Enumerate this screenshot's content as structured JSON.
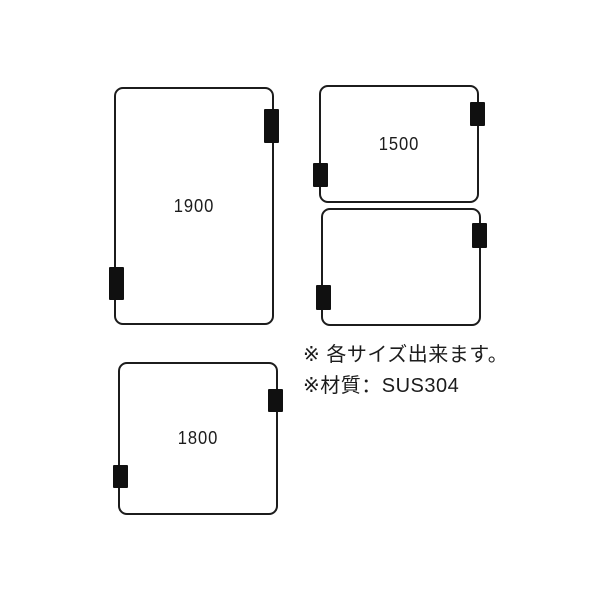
{
  "diagram": {
    "panels": [
      {
        "id": "panel-1900",
        "label": "1900"
      },
      {
        "id": "panel-1500",
        "label": "1500"
      },
      {
        "id": "panel-unlabeled",
        "label": ""
      },
      {
        "id": "panel-1800",
        "label": "1800"
      }
    ],
    "notes": {
      "line1": "※ 各サイズ出来ます。",
      "line2": "※材質：SUS304"
    },
    "icons": {
      "hinge": "filled-black-rectangle"
    },
    "colors": {
      "line": "#1c1c1c",
      "hinge": "#101010",
      "background": "#ffffff"
    }
  }
}
